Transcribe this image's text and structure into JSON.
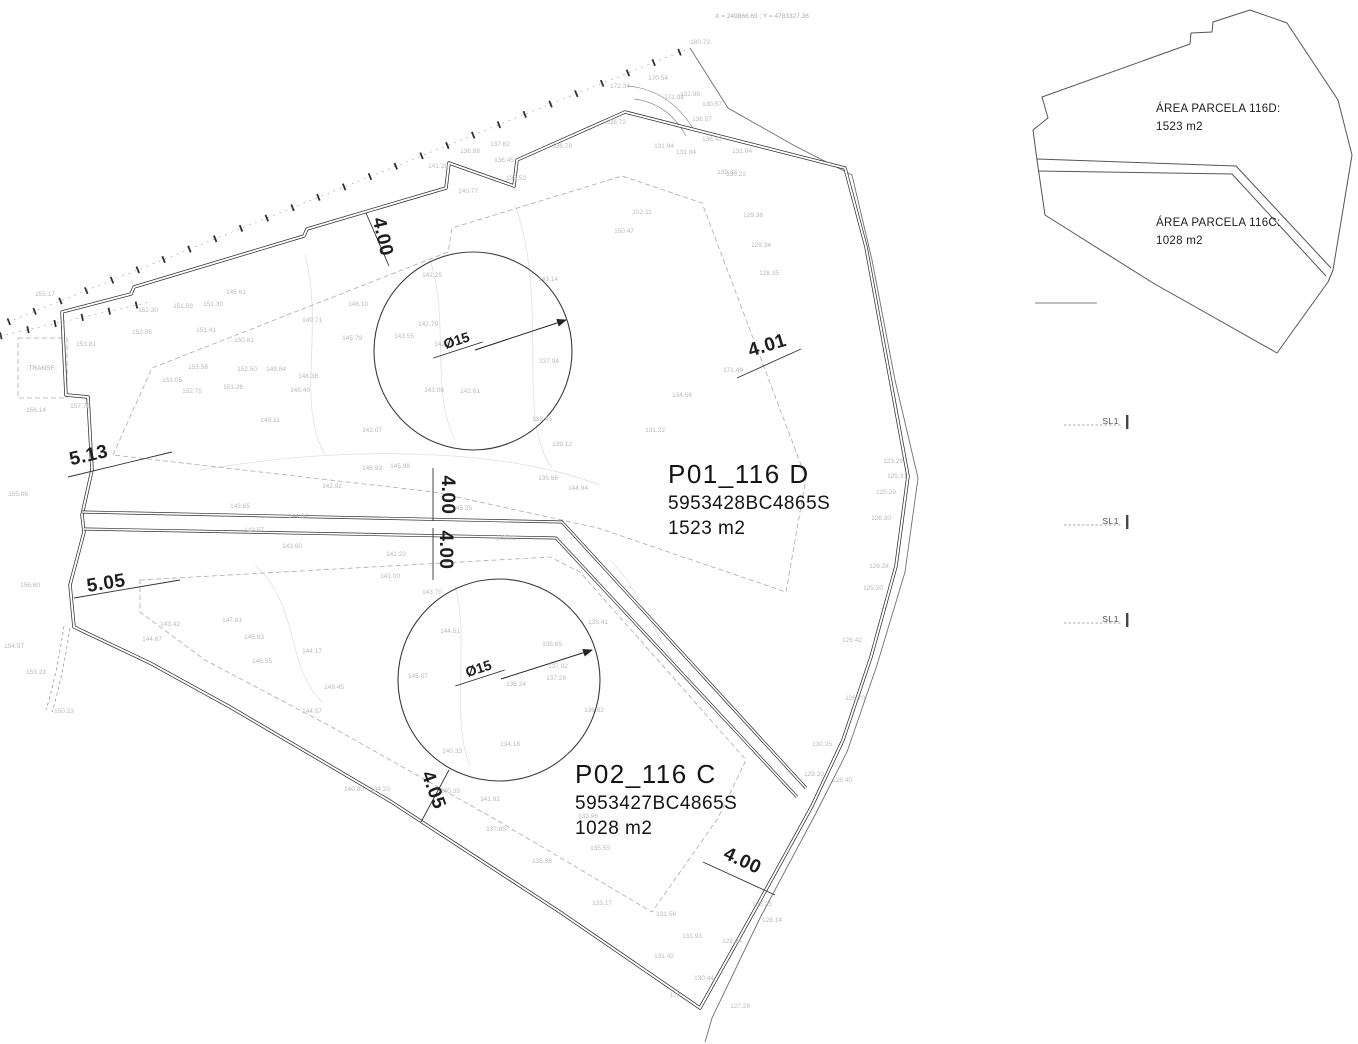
{
  "colors": {
    "ink": "#2f2f2f",
    "faint_gray": "#b9b9b9",
    "dashed_gray": "#ababab",
    "paper": "#ffffff"
  },
  "header": {
    "coords_text": "X = 249866.69 ; Y = 4783327.36"
  },
  "main_plan": {
    "parcel_labels": [
      {
        "title": "P01_116 D",
        "ref": "5953428BC4865S",
        "area": "1523 m2",
        "x": 668,
        "y": 483
      },
      {
        "title": "P02_116 C",
        "ref": "5953427BC4865S",
        "area": "1028 m2",
        "x": 575,
        "y": 783
      }
    ],
    "dimensions": [
      {
        "label": "4.00",
        "x": 377,
        "y": 238,
        "rot": 77
      },
      {
        "label": "5.13",
        "x": 90,
        "y": 461,
        "rot": -13
      },
      {
        "label": "4.01",
        "x": 769,
        "y": 351,
        "rot": -17
      },
      {
        "label": "4.00",
        "x": 442,
        "y": 495,
        "rot": 90
      },
      {
        "label": "4.00",
        "x": 440,
        "y": 550,
        "rot": 90
      },
      {
        "label": "5.05",
        "x": 107,
        "y": 589,
        "rot": -9
      },
      {
        "label": "4.05",
        "x": 428,
        "y": 792,
        "rot": 70
      },
      {
        "label": "4.00",
        "x": 740,
        "y": 866,
        "rot": 25
      }
    ],
    "diameter_labels": [
      {
        "label": "Ø15",
        "x": 458,
        "y": 345,
        "rot": -18
      },
      {
        "label": "Ø15",
        "x": 480,
        "y": 673,
        "rot": -18
      }
    ],
    "annotations": [
      {
        "v": "TRANSF.",
        "x": 42,
        "y": 370
      }
    ],
    "spot_elevations": [
      [
        "141.28",
        438,
        168
      ],
      [
        "136.88",
        470,
        153
      ],
      [
        "137.82",
        500,
        146
      ],
      [
        "136.45",
        504,
        162
      ],
      [
        "138.53",
        516,
        180
      ],
      [
        "140.77",
        468,
        193
      ],
      [
        "136.78",
        562,
        148
      ],
      [
        "138.72",
        616,
        124
      ],
      [
        "131.94",
        664,
        148
      ],
      [
        "131.84",
        686,
        154
      ],
      [
        "136.42",
        712,
        141
      ],
      [
        "139.33",
        727,
        174
      ],
      [
        "132.98",
        690,
        96
      ],
      [
        "130.57",
        712,
        106
      ],
      [
        "172.34",
        620,
        88
      ],
      [
        "170.54",
        658,
        80
      ],
      [
        "172.98",
        674,
        99
      ],
      [
        "136.57",
        702,
        121
      ],
      [
        "180.73",
        700,
        44
      ],
      [
        "130.22",
        736,
        176
      ],
      [
        "131.04",
        742,
        153
      ],
      [
        "129.38",
        753,
        217
      ],
      [
        "129.34",
        761,
        247
      ],
      [
        "128.35",
        769,
        275
      ],
      [
        "152.11",
        642,
        214
      ],
      [
        "150.47",
        624,
        233
      ],
      [
        "155.17",
        45,
        296
      ],
      [
        "153.81",
        86,
        346
      ],
      [
        "156.14",
        36,
        412
      ],
      [
        "157.76",
        80,
        408
      ],
      [
        "156.60",
        30,
        587
      ],
      [
        "155.06",
        18,
        496
      ],
      [
        "153.23",
        36,
        674
      ],
      [
        "150.23",
        64,
        713
      ],
      [
        "154.57",
        14,
        648
      ],
      [
        "152.30",
        148,
        312
      ],
      [
        "151.59",
        183,
        308
      ],
      [
        "151.30",
        213,
        306
      ],
      [
        "145.61",
        236,
        294
      ],
      [
        "152.05",
        142,
        334
      ],
      [
        "151.41",
        206,
        332
      ],
      [
        "150.81",
        244,
        342
      ],
      [
        "153.58",
        198,
        369
      ],
      [
        "152.50",
        247,
        371
      ],
      [
        "149.84",
        276,
        371
      ],
      [
        "148.38",
        308,
        378
      ],
      [
        "151.05",
        172,
        382
      ],
      [
        "152.75",
        192,
        393
      ],
      [
        "151.26",
        233,
        389
      ],
      [
        "149.71",
        312,
        322
      ],
      [
        "146.10",
        358,
        306
      ],
      [
        "145.79",
        352,
        340
      ],
      [
        "148.40",
        300,
        392
      ],
      [
        "149.11",
        270,
        422
      ],
      [
        "146.93",
        372,
        470
      ],
      [
        "145.98",
        400,
        468
      ],
      [
        "145.25",
        462,
        510
      ],
      [
        "144.94",
        578,
        490
      ],
      [
        "143.02",
        506,
        540
      ],
      [
        "143.65",
        240,
        508
      ],
      [
        "144.84",
        298,
        518
      ],
      [
        "142.92",
        332,
        488
      ],
      [
        "143.57",
        254,
        532
      ],
      [
        "143.60",
        292,
        548
      ],
      [
        "141.22",
        396,
        556
      ],
      [
        "141.00",
        390,
        578
      ],
      [
        "135.66",
        548,
        480
      ],
      [
        "142.25",
        432,
        277
      ],
      [
        "142.79",
        428,
        326
      ],
      [
        "143.55",
        404,
        338
      ],
      [
        "142.88",
        444,
        346
      ],
      [
        "143.08",
        434,
        392
      ],
      [
        "142.61",
        470,
        393
      ],
      [
        "143.14",
        548,
        281
      ],
      [
        "137.94",
        549,
        363
      ],
      [
        "139.45",
        542,
        421
      ],
      [
        "139.12",
        562,
        446
      ],
      [
        "143.07",
        372,
        432
      ],
      [
        "171.49",
        733,
        372
      ],
      [
        "134.56",
        682,
        397
      ],
      [
        "131.22",
        655,
        432
      ],
      [
        "143.70",
        432,
        594
      ],
      [
        "144.51",
        450,
        633
      ],
      [
        "145.07",
        418,
        678
      ],
      [
        "135.65",
        552,
        646
      ],
      [
        "137.02",
        558,
        668
      ],
      [
        "137.28",
        556,
        680
      ],
      [
        "136.24",
        516,
        686
      ],
      [
        "134.18",
        510,
        746
      ],
      [
        "140.33",
        452,
        753
      ],
      [
        "135.41",
        598,
        624
      ],
      [
        "136.82",
        594,
        712
      ],
      [
        "147.81",
        232,
        622
      ],
      [
        "143.42",
        170,
        626
      ],
      [
        "144.67",
        152,
        641
      ],
      [
        "145.93",
        254,
        639
      ],
      [
        "144.17",
        312,
        653
      ],
      [
        "146.55",
        262,
        663
      ],
      [
        "149.45",
        334,
        689
      ],
      [
        "144.57",
        312,
        713
      ],
      [
        "140.80",
        354,
        791
      ],
      [
        "134.23",
        380,
        791
      ],
      [
        "140.35",
        450,
        793
      ],
      [
        "141.92",
        490,
        801
      ],
      [
        "137.85",
        496,
        831
      ],
      [
        "135.86",
        542,
        863
      ],
      [
        "135.55",
        600,
        850
      ],
      [
        "133.96",
        588,
        818
      ],
      [
        "133.17",
        602,
        905
      ],
      [
        "131.56",
        666,
        916
      ],
      [
        "131.93",
        692,
        938
      ],
      [
        "131.42",
        664,
        958
      ],
      [
        "129.24",
        732,
        943
      ],
      [
        "130.44",
        704,
        980
      ],
      [
        "170",
        675,
        997
      ],
      [
        "127.28",
        740,
        1008
      ],
      [
        "128.14",
        772,
        922
      ],
      [
        "138.25",
        762,
        906
      ],
      [
        "123.29",
        893,
        463
      ],
      [
        "125.31",
        897,
        478
      ],
      [
        "125.29",
        886,
        494
      ],
      [
        "126.30",
        881,
        520
      ],
      [
        "126.24",
        879,
        568
      ],
      [
        "125.20",
        873,
        590
      ],
      [
        "126.42",
        852,
        642
      ],
      [
        "130.25",
        822,
        746
      ],
      [
        "129.20",
        814,
        776
      ],
      [
        "128.40",
        842,
        782
      ],
      [
        "126.70",
        855,
        700
      ]
    ]
  },
  "inset": {
    "area_d_title": "ÁREA PARCELA 116D:",
    "area_d_value": "1523 m2",
    "area_c_title": "ÁREA PARCELA 116C:",
    "area_c_value": "1028 m2"
  },
  "section_markers": [
    {
      "label": "SL1",
      "x": 1126,
      "y": 421
    },
    {
      "label": "SL1",
      "x": 1126,
      "y": 521
    },
    {
      "label": "SL1",
      "x": 1126,
      "y": 619
    }
  ]
}
